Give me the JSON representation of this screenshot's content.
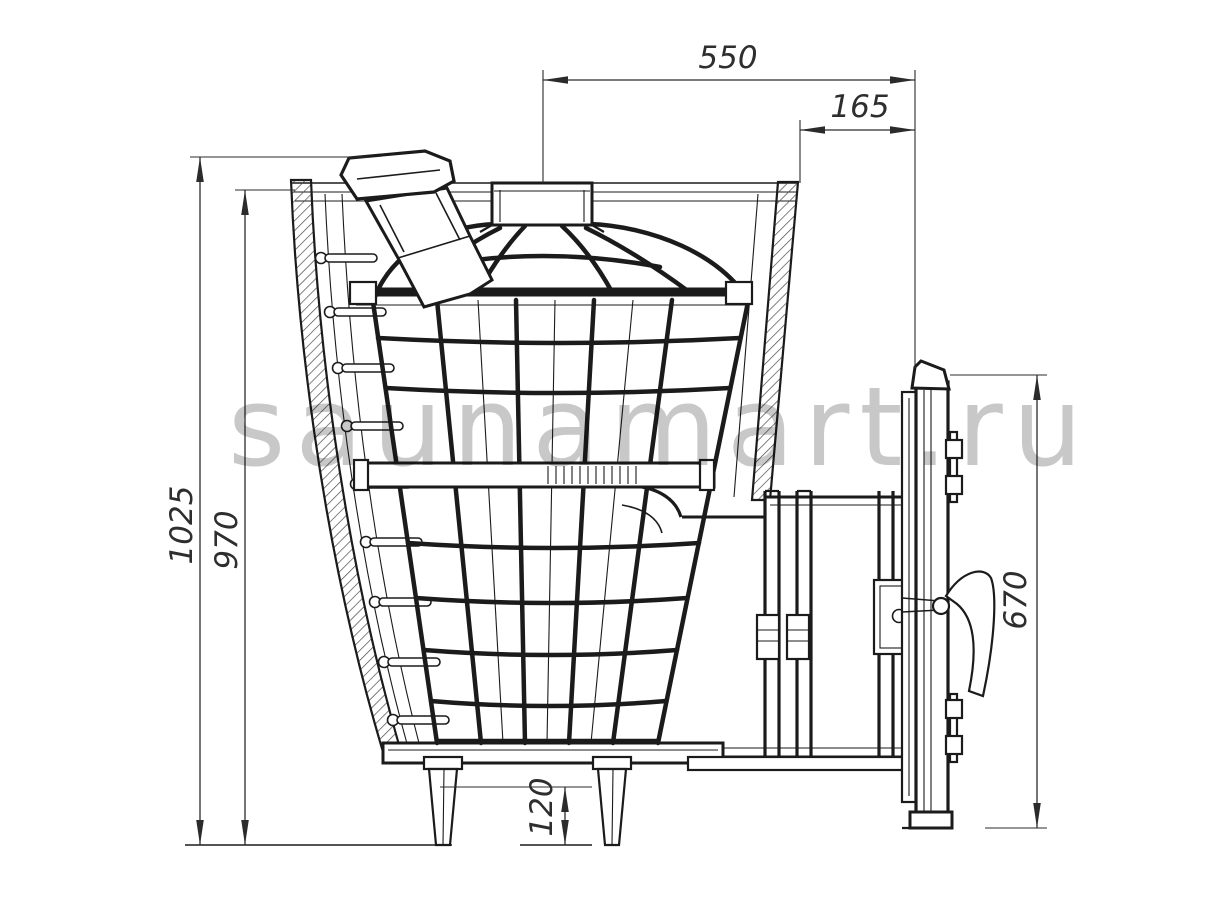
{
  "drawing": {
    "watermark": "saunamart.ru",
    "dimensions": {
      "top_width": "550",
      "door_offset": "165",
      "total_height": "1025",
      "body_height": "970",
      "door_height": "670",
      "leg_height": "120"
    },
    "colors": {
      "background": "#ffffff",
      "line": "#1b1b1b",
      "dimension_text": "#2e2e2e",
      "watermark": "#c8c8c8"
    }
  }
}
